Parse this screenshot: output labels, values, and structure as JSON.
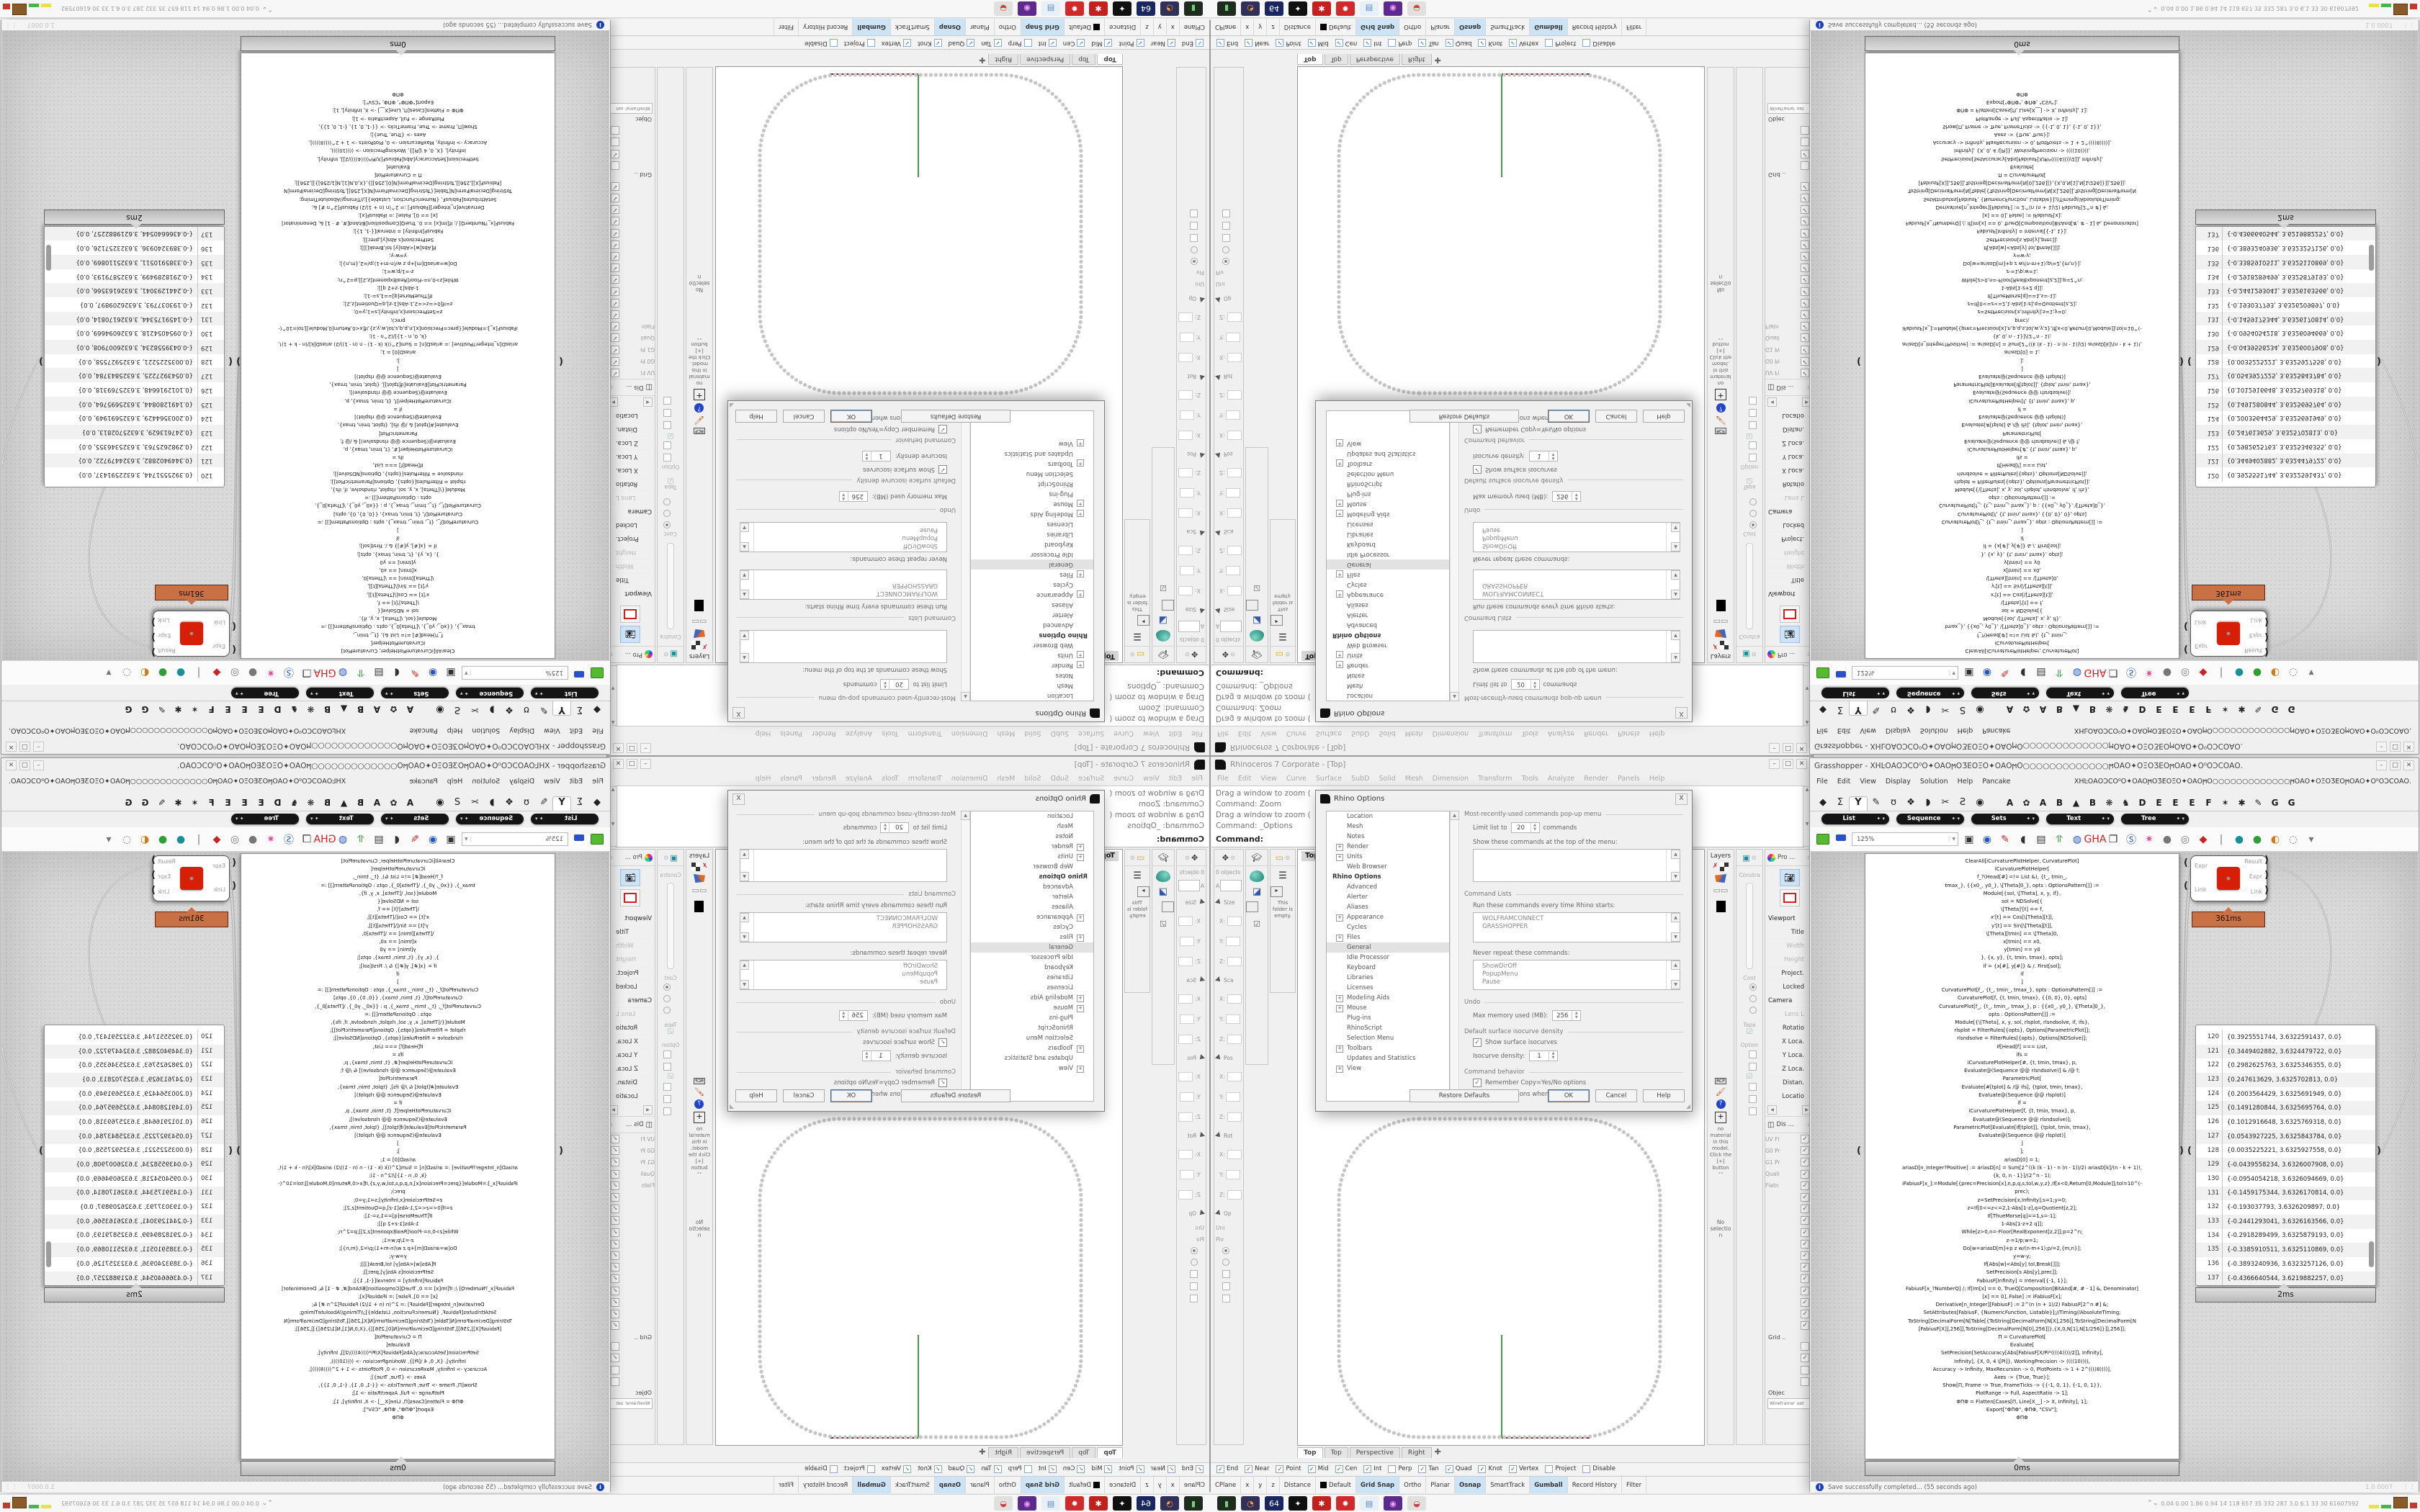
{
  "rhino": {
    "title": "Rhinoceros 7 Corporate - [Top]",
    "window_buttons": [
      "_",
      "□",
      "X"
    ],
    "menu": [
      "File",
      "Edit",
      "View",
      "Curve",
      "Surface",
      "SubD",
      "Solid",
      "Mesh",
      "Dimension",
      "Transform",
      "Tools",
      "Analyze",
      "Render",
      "Panels",
      "Help"
    ],
    "command_history": [
      "Drag a window to zoom (",
      "Command: Zoom",
      "Drag a window to zoom (",
      "Command: _Options"
    ],
    "command_prompt": "Command:",
    "viewport_label": "Top",
    "viewport_tabs": [
      {
        "t": "Top",
        "cls": "on"
      },
      {
        "t": "Top",
        "cls": ""
      },
      {
        "t": "Perspective",
        "cls": ""
      },
      {
        "t": "Right",
        "cls": ""
      },
      {
        "t": "✚",
        "cls": "plus"
      }
    ],
    "plot": {
      "curve_color": "#c6c6c6",
      "y_axis_color": "#1e7d1e",
      "x_axis_color": "#7a1f1f"
    },
    "boxedit_rows": [
      {
        "k": "txt",
        "t": "0 objects"
      },
      {
        "k": "inp",
        "t": "A"
      },
      {
        "k": "sec",
        "t": "Size"
      },
      {
        "k": "fld",
        "t": "X:"
      },
      {
        "k": "fld",
        "t": "Y:"
      },
      {
        "k": "fld",
        "t": "Z:"
      },
      {
        "k": "sec",
        "t": "Sca"
      },
      {
        "k": "fld",
        "t": "X:"
      },
      {
        "k": "fld",
        "t": "Y:"
      },
      {
        "k": "fld",
        "t": "Z:"
      },
      {
        "k": "sec",
        "t": "Pos"
      },
      {
        "k": "fld",
        "t": "X:"
      },
      {
        "k": "fld",
        "t": "Y:"
      },
      {
        "k": "fld",
        "t": "Z:"
      },
      {
        "k": "sec",
        "t": "Rot"
      },
      {
        "k": "fld",
        "t": "X:"
      },
      {
        "k": "fld",
        "t": "Y:"
      },
      {
        "k": "fld",
        "t": "Z:"
      },
      {
        "k": "sec",
        "t": "Op"
      },
      {
        "k": "txt",
        "t": "Uni"
      },
      {
        "k": "txt",
        "t": "Piv"
      },
      {
        "k": "radio-on",
        "t": ""
      },
      {
        "k": "radio-off",
        "t": ""
      },
      {
        "k": "chk",
        "t": ""
      },
      {
        "k": "chk",
        "t": ""
      },
      {
        "k": "chk",
        "t": ""
      }
    ],
    "folder_empty_msg": "This folder is empty.",
    "layers_title": "Layers",
    "materials_msg": "no material in this model. Click the [+] button",
    "materials_more": "˅˅",
    "no_selection": "No selection",
    "constra": {
      "head": "Constra",
      "mid": "Cont",
      "taper": "Tapa",
      "options": "Option"
    },
    "props_header": "Pro ...",
    "props_rows": [
      {
        "t": "Viewport",
        "cls": "sec"
      },
      {
        "t": "Title",
        "cls": ""
      },
      {
        "t": "Width",
        "cls": "dim"
      },
      {
        "t": "Height",
        "cls": "dim"
      },
      {
        "t": "Project.",
        "cls": ""
      },
      {
        "t": "Locked",
        "cls": ""
      },
      {
        "t": "Camera",
        "cls": "sec"
      },
      {
        "t": "Lens L",
        "cls": "dim"
      },
      {
        "t": "Rotatio",
        "cls": ""
      },
      {
        "t": "X Loca.",
        "cls": ""
      },
      {
        "t": "Y Loca.",
        "cls": ""
      },
      {
        "t": "Z Loca.",
        "cls": ""
      },
      {
        "t": "Distan.",
        "cls": ""
      },
      {
        "t": "Locatio",
        "cls": ""
      }
    ],
    "display_header": "Dis ...",
    "display_checks": [
      {
        "l": "UV Fl",
        "m": "✓"
      },
      {
        "l": "G0 Pr",
        "m": "✓"
      },
      {
        "l": "G1 Pr",
        "m": "✓"
      },
      {
        "l": "Quali",
        "m": "✓"
      },
      {
        "l": "Flatn",
        "m": "✓"
      },
      {
        "l": "",
        "m": "✓"
      },
      {
        "l": "",
        "m": "✓"
      },
      {
        "l": "",
        "m": "✓"
      },
      {
        "l": "",
        "m": "✓"
      },
      {
        "l": "",
        "m": "✓"
      },
      {
        "l": "",
        "m": "✓"
      },
      {
        "l": "",
        "m": "✓"
      },
      {
        "l": "",
        "m": "✓"
      },
      {
        "l": "",
        "m": "✓"
      },
      {
        "l": "",
        "m": "✓"
      },
      {
        "l": "",
        "m": "✓"
      },
      {
        "l": "",
        "m": "✓"
      }
    ],
    "grid_label": "Grid ..",
    "grid_checks": [
      {
        "l": "",
        "m": ""
      },
      {
        "l": "",
        "m": "✓"
      },
      {
        "l": "",
        "m": ""
      },
      {
        "l": "",
        "m": ""
      }
    ],
    "objec_label": "Objec",
    "objec_value": "Wireframe' set",
    "osnap": [
      {
        "t": "End",
        "m": "✓"
      },
      {
        "t": "Near",
        "m": "✓"
      },
      {
        "t": "Point",
        "m": "✓"
      },
      {
        "t": "Mid",
        "m": "✓"
      },
      {
        "t": "Cen",
        "m": "✓"
      },
      {
        "t": "Int",
        "m": "✓"
      },
      {
        "t": "Perp",
        "m": ""
      },
      {
        "t": "Tan",
        "m": "✓"
      },
      {
        "t": "Quad",
        "m": "✓"
      },
      {
        "t": "Knot",
        "m": "✓"
      },
      {
        "t": "Vertex",
        "m": "✓"
      },
      {
        "t": "Project",
        "m": ""
      },
      {
        "t": "Disable",
        "m": ""
      }
    ],
    "status_cells": [
      {
        "t": "CPlane",
        "cls": "",
        "w": 60
      },
      {
        "t": "x",
        "cls": "",
        "w": 70
      },
      {
        "t": "y",
        "cls": "",
        "w": 70
      },
      {
        "t": "z",
        "cls": "",
        "w": 70
      },
      {
        "t": "Distance",
        "cls": "",
        "w": 70
      },
      {
        "t": "Default",
        "cls": "sw",
        "w": 100
      },
      {
        "t": "Grid Snap",
        "cls": "on",
        "w": 0
      },
      {
        "t": "Ortho",
        "cls": "",
        "w": 0
      },
      {
        "t": "Planar",
        "cls": "",
        "w": 0
      },
      {
        "t": "Osnap",
        "cls": "on",
        "w": 0
      },
      {
        "t": "SmartTrack",
        "cls": "",
        "w": 0
      },
      {
        "t": "Gumball",
        "cls": "on",
        "w": 0
      },
      {
        "t": "Record History",
        "cls": "",
        "w": 0
      },
      {
        "t": "Filter",
        "cls": "",
        "w": 0
      }
    ]
  },
  "dialog": {
    "title": "Rhino Options",
    "close": "X",
    "tree": [
      {
        "t": "Location",
        "cls": ""
      },
      {
        "t": "Mesh",
        "cls": ""
      },
      {
        "t": "Notes",
        "cls": ""
      },
      {
        "t": "Render",
        "cls": "plus"
      },
      {
        "t": "Units",
        "cls": "plus"
      },
      {
        "t": "Web Browser",
        "cls": ""
      },
      {
        "t": "Rhino Options",
        "cls": "sec"
      },
      {
        "t": "Advanced",
        "cls": ""
      },
      {
        "t": "Alerter",
        "cls": ""
      },
      {
        "t": "Aliases",
        "cls": ""
      },
      {
        "t": "Appearance",
        "cls": "plus"
      },
      {
        "t": "Cycles",
        "cls": ""
      },
      {
        "t": "Files",
        "cls": "plus"
      },
      {
        "t": "General",
        "cls": "sel"
      },
      {
        "t": "Idle Processor",
        "cls": ""
      },
      {
        "t": "Keyboard",
        "cls": ""
      },
      {
        "t": "Libraries",
        "cls": ""
      },
      {
        "t": "Licenses",
        "cls": ""
      },
      {
        "t": "Modeling Aids",
        "cls": "plus"
      },
      {
        "t": "Mouse",
        "cls": "plus"
      },
      {
        "t": "Plug-ins",
        "cls": ""
      },
      {
        "t": "RhinoScript",
        "cls": ""
      },
      {
        "t": "Selection Menu",
        "cls": ""
      },
      {
        "t": "Toolbars",
        "cls": "plus"
      },
      {
        "t": "Updates and Statistics",
        "cls": ""
      },
      {
        "t": "View",
        "cls": "plus"
      }
    ],
    "grp_mru": "Most-recently-used commands pop-up menu",
    "limit_label": "Limit list to",
    "limit_value": "20",
    "limit_suffix": "commands",
    "show_top_label": "Show these commands at the top of the menu:",
    "grp_cmdlists": "Command Lists",
    "run_label": "Run these commands every time Rhino starts:",
    "run_items": [
      "WOLFRAMCONNECT",
      "GRASSHOPPER"
    ],
    "never_label": "Never repeat these commands:",
    "never_items": [
      "ShowDirOff",
      "PopupMenu",
      "Pause"
    ],
    "grp_undo": "Undo",
    "undo_label": "Max memory used (MB):",
    "undo_value": "256",
    "grp_iso": "Default surface isocurve density",
    "iso_check": "Show surface isocurves",
    "iso_label": "Isocurve density:",
    "iso_value": "1",
    "grp_behavior": "Command behavior",
    "behavior_checks": [
      "Remember Copy=Yes/No options",
      "Use extrusions when possible"
    ],
    "btn_restore": "Restore Defaults",
    "btn_ok": "OK",
    "btn_cancel": "Cancel",
    "btn_help": "Help"
  },
  "grasshopper": {
    "title_prefix": "Grasshopper - ",
    "doc_name": "XHĿΟΑΟϽϹΟ⁰Ο✦ΟΑΟϻΟƷΕΟΞΟ✦ΟΑΟϻΟ○○○○○○○○○○○○○ϻΟΑΟ✦ΟΞΟƷΕΟϻΟΑΟ✦Ο⁰ΟϽϹΟΑΟ.",
    "menu": [
      "File",
      "Edit",
      "View",
      "Display",
      "Solution",
      "Help",
      "Pancake"
    ],
    "ribbon_icons": [
      {
        "g": "◆",
        "cls": ""
      },
      {
        "g": "Σ",
        "cls": ""
      },
      {
        "g": "Y",
        "cls": "on"
      },
      {
        "g": "✎",
        "cls": ""
      },
      {
        "g": "ʊ",
        "cls": ""
      },
      {
        "g": "❖",
        "cls": ""
      },
      {
        "g": "◗",
        "cls": ""
      },
      {
        "g": "✂",
        "cls": ""
      },
      {
        "g": "Ƨ",
        "cls": ""
      },
      {
        "g": "◉",
        "cls": ""
      }
    ],
    "ribbon_letters": [
      {
        "g": "A",
        "cls": ""
      },
      {
        "g": "✿",
        "cls": "ico"
      },
      {
        "g": "A",
        "cls": ""
      },
      {
        "g": "B",
        "cls": ""
      },
      {
        "g": "▲",
        "cls": "ico"
      },
      {
        "g": "B",
        "cls": ""
      },
      {
        "g": "❋",
        "cls": "ico"
      },
      {
        "g": "♞",
        "cls": "ico"
      },
      {
        "g": "D",
        "cls": ""
      },
      {
        "g": "E",
        "cls": ""
      },
      {
        "g": "E",
        "cls": ""
      },
      {
        "g": "E",
        "cls": ""
      },
      {
        "g": "F",
        "cls": ""
      },
      {
        "g": "✶",
        "cls": "ico"
      },
      {
        "g": "✱",
        "cls": "ico"
      },
      {
        "g": "✎",
        "cls": "ico"
      },
      {
        "g": "G",
        "cls": ""
      },
      {
        "g": "G",
        "cls": ""
      }
    ],
    "pills": [
      "List",
      "Sequence",
      "Sets",
      "Text",
      "Tree"
    ],
    "pill_arrow": "✦ ▾",
    "zoom_value": "125%",
    "toolbar_icons": [
      {
        "g": "▣",
        "cls": "c-dark"
      },
      {
        "g": "◉",
        "cls": "c-blu"
      },
      {
        "g": "✎",
        "cls": "c-red"
      },
      {
        "g": "◖",
        "cls": "c-dark"
      },
      {
        "g": "▤",
        "cls": "c-dark"
      },
      {
        "g": "⥣",
        "cls": "c-grn"
      },
      {
        "g": "◍",
        "cls": "c-blu"
      },
      {
        "g": "GHA",
        "cls": "c-red gha"
      },
      {
        "g": "❐",
        "cls": "c-dark"
      },
      {
        "g": "Ⓢ",
        "cls": "c-blu"
      },
      {
        "g": "✷",
        "cls": "c-pink"
      },
      {
        "g": "●",
        "cls": "c-gray"
      },
      {
        "g": "◎",
        "cls": "c-gray"
      },
      {
        "g": "◆",
        "cls": "c-red"
      },
      {
        "g": "|",
        "cls": "c-gray"
      },
      {
        "g": "●",
        "cls": "c-teal"
      },
      {
        "g": "●",
        "cls": "c-grn"
      },
      {
        "g": "◐",
        "cls": "c-org"
      },
      {
        "g": "◌",
        "cls": "c-gray"
      },
      {
        "g": "▾",
        "cls": "c-gray"
      }
    ],
    "component": {
      "inputs": [
        "Expr",
        "Link"
      ],
      "outputs": [
        "Result",
        "Expr",
        "Link"
      ],
      "icon": "✹",
      "timer": "361ms"
    },
    "tooltip_code": "0ms",
    "tooltip_data": "2ms",
    "code_lines": [
      "ClearAll[iCurvaturePlotHelper, CurvaturePlot]",
      "iCurvaturePlotHelper[",
      "f_?(Head[#] =!= List &), {t_, tmin_,",
      "tmax_}, {{x0_, y0_}, \\[Theta]0_}, opts : OptionsPattern[]] :=",
      "Module[{sol, \\[Theta], x, y, if},",
      "sol = NDSolve[{",
      "\\[Theta]'[t] == f,",
      "x'[t] == Cos[\\[Theta][t]],",
      "y'[t] == Sin[\\[Theta][t]],",
      "\\[Theta][tmin] == \\[Theta]0,",
      "x[tmin] == x0,",
      "y[tmin] == y0",
      "}, {x, y}, {t, tmin, tmax}, opts];",
      "if = {x[#], y[#]} & /. First[sol];",
      "if",
      "]",
      "CurvaturePlot[f_, {t_, tmin_, tmax_}, opts : OptionsPattern[]] :=",
      "CurvaturePlot[f, {t, tmin, tmax}, {{0, 0}, 0}, opts]",
      "CurvaturePlot[f_, {t_, tmin_, tmax_}, p : {{x0_, y0_}, \\[Theta]0_},",
      "opts : OptionsPattern[]] :=",
      "Module[{\\[Theta], x, y, sol, rlsplot, rlsndsolve, if, ifs},",
      "rlsplot = FilterRules[{opts}, Options[ParametricPlot]];",
      "rlsndsolve = FilterRules[{opts}, Options[NDSolve]];",
      "If[Head[f] === List,",
      "ifs =",
      "iCurvaturePlotHelper[#, {t, tmin, tmax}, p,",
      "Evaluate@(Sequence @@ rlsndsolve)] & /@ f;",
      "ParametricPlot[",
      "Evaluate[#[tplot] & /@ ifs], {tplot, tmin, tmax},",
      "Evaluate@(Sequence @@ rlsplot)]",
      "",
      "if =",
      "iCurvaturePlotHelper[f, {t, tmin, tmax}, p,",
      "Evaluate@(Sequence @@ rlsndsolve)];",
      "ParametricPlot[Evaluate[if[tplot]], {tplot, tmin, tmax},",
      "Evaluate@(Sequence @@ rlsplot)]",
      "]",
      "];",
      "",
      "ariasD[0] = 1;",
      "ariasD[n_Integer?Positive] := ariasD[n] = Sum[2^((k (k - 1) - n (n - 1))/2) ariasD[k]/(n - k + 1)!,",
      "{k, 0, n - 1}]/(2^n - 1);",
      "iFabiusF[x_]:=Module[{prec=Precision[x],n,p,q,s,tol,w,y,z},If[x<0,Return[0,Module]];tol=10^(-",
      "prec);",
      "z=SetPrecision[x,Infinity];s=1;y=0;",
      "z=If[0<=z<=2,1-Abs[1-z],q=Quotient[z,2];",
      "If[ThueMorse[q]==1,s=-1];",
      "1-Abs[1-z+2 q]];",
      "While[z>0,n=-Floor[RealExponent[z,2]];p=2^n;",
      "z-=1/p;w=1;",
      "Do[w=ariasD[m]+p z w/(n-m+1);p/=2,{m,n}];",
      "y=w-y;",
      "If[Abs[w]<Abs[y] tol,Break[]]];",
      "SetPrecision[s Abs[y],prec]];",
      "FabiusF[Infinity] = Interval[{-1, 1}];",
      "FabiusF[x_?NumberQ] /; If[Im[x] == 0, TrueQ[Composition[BitAnd[#, # - 1] &, Denominator]",
      "[x] == 0], False] := iFabiusF[x];",
      "Derivative[n_Integer][FabiusF] := 2^(n (n + 1)/2) FabiusF[2^n #] &;",
      "SetAttributes[FabiusF, {NumericFunction, Listable}];//Timing//AbsoluteTiming;",
      "",
      "ToString[DecimalForm[N[Table[{ToString[DecimalForm[N[X],256]],ToString[DecimalForm[N",
      "[FabiusF[X]],256]],ToString[DecimalForm[N[0],256]]},{X,0,N[1],N[1/256]}]],256]];",
      "",
      "Π = CurvaturePlot[",
      "Evaluate[",
      "SetPrecision[SetAccuracy[Abs[FabiusF[X/Pi*((((4))))/2]], Infinity],",
      "Infinity], {X, 0, 4 \\[Pi]}, WorkingPrecision -> ((((10)))),",
      "Accuracy -> Infinity, MaxRecursion -> 0, PlotPoints -> 1 + 2^((((8))))],",
      "Axes -> {True, True}];",
      "Show[Π, Frame -> True, FrameTicks -> {{-1, 0, 1}, {-1, 0, 1}},",
      "PlotRange -> Full, AspectRatio -> 1];",
      "ΦΠΦ = Flatten[Cases[Π, Line[X__] -> X, Infinity], 1];",
      "Export[\"ΦΠΦ\", ΦΠΦ, \"CSV\"];",
      "ΦΠΦ"
    ],
    "data_rows": [
      {
        "i": "120",
        "v": "{0.3925551744, 3.6322591437, 0.0}",
        "cls": ""
      },
      {
        "i": "121",
        "v": "{0.3449402882, 3.6324479722, 0.0}",
        "cls": "odd"
      },
      {
        "i": "122",
        "v": "{0.2982625763, 3.6325346355, 0.0}",
        "cls": ""
      },
      {
        "i": "123",
        "v": "{0.247613629, 3.6325702813, 0.0}",
        "cls": "odd"
      },
      {
        "i": "124",
        "v": "{0.2003564429, 3.6325691949, 0.0}",
        "cls": ""
      },
      {
        "i": "125",
        "v": "{0.1491280844, 3.6325695764, 0.0}",
        "cls": "odd"
      },
      {
        "i": "126",
        "v": "{0.1012916648, 3.6325769318, 0.0}",
        "cls": ""
      },
      {
        "i": "127",
        "v": "{0.0543927225, 3.6325843784, 0.0}",
        "cls": "odd"
      },
      {
        "i": "128",
        "v": "{0.0035225221, 3.6325927558, 0.0}",
        "cls": ""
      },
      {
        "i": "129",
        "v": "{-0.0439558234, 3.6326007908, 0.0}",
        "cls": "odd"
      },
      {
        "i": "130",
        "v": "{-0.0954054218, 3.6326094669, 0.0}",
        "cls": ""
      },
      {
        "i": "131",
        "v": "{-0.1459175344, 3.6326170814, 0.0}",
        "cls": "odd"
      },
      {
        "i": "132",
        "v": "{-0.193037793, 3.6326209897, 0.0}",
        "cls": ""
      },
      {
        "i": "133",
        "v": "{-0.2441293041, 3.6326163566, 0.0}",
        "cls": "odd"
      },
      {
        "i": "134",
        "v": "{-0.2918289499, 3.6325879193, 0.0}",
        "cls": ""
      },
      {
        "i": "135",
        "v": "{-0.3385910511, 3.6325110869, 0.0}",
        "cls": "odd"
      },
      {
        "i": "136",
        "v": "{-0.3893240936, 3.6323257126, 0.0}",
        "cls": ""
      },
      {
        "i": "137",
        "v": "{-0.4366640544, 3.6219882257, 0.0}",
        "cls": "odd"
      }
    ],
    "toast": "Save successfully completed... (55 seconds ago)",
    "version": "1.0.0007"
  },
  "taskbar": {
    "icons": [
      {
        "g": "▮",
        "bg": "#1e2b1e",
        "c": "#72d376"
      },
      {
        "g": "◔",
        "bg": "#30305a",
        "c": "#ff9a3c"
      },
      {
        "g": "64",
        "bg": "#1a2660",
        "c": "#ffffff"
      },
      {
        "g": "✦",
        "bg": "#101010",
        "c": "#ffffff"
      },
      {
        "g": "✱",
        "bg": "#c32020",
        "c": "#ffffff"
      },
      {
        "g": "✹",
        "bg": "#d12a2a",
        "c": "#ffffff"
      },
      {
        "g": "▤",
        "bg": "#e9eff6",
        "c": "#5588bb"
      },
      {
        "g": "◉",
        "bg": "#5c2a8c",
        "c": "#f3a0ff"
      },
      {
        "g": "◒",
        "bg": "#e0e0e0",
        "c": "#cc4433"
      }
    ],
    "person_icon": "⌃⌄",
    "stats": "0.04 0.00 1.86 0.94    14    118  657    35    332  287    3.0    6.1    33    30    61607592"
  }
}
